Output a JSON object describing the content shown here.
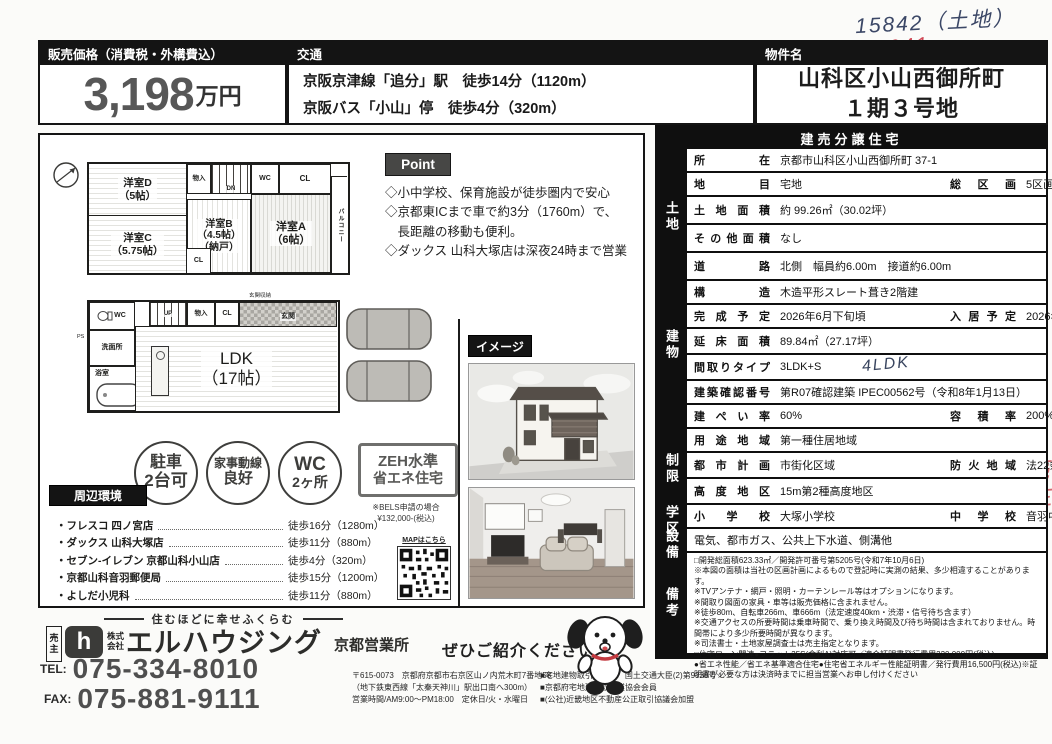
{
  "annotations": {
    "note_dark": "15842（土地）",
    "note_red": "16041",
    "side_note": "売主"
  },
  "header": {
    "price_label": "販売価格（消費税・外構費込）",
    "price_value": "3,198",
    "price_unit": "万円",
    "transport_label": "交通",
    "transport_line1": "京阪京津線「追分」駅　徒歩14分（1120m）",
    "transport_line2": "京阪バス「小山」停　徒歩4分（320m）",
    "property_label": "物件名",
    "property_line1": "山科区小山西御所町",
    "property_line2": "１期３号地"
  },
  "floorplan": {
    "f2": {
      "room_d": "洋室D\n（5帖）",
      "room_c": "洋室C\n（5.75帖）",
      "room_b": "洋室B\n（4.5帖）\n（納戸）",
      "room_a": "洋室A\n（6帖）",
      "closet": "物入",
      "wc": "WC",
      "cl_top": "CL",
      "cl_mid": "CL",
      "balcony": "バルコニー",
      "dn": "DN"
    },
    "f1": {
      "wc": "WC",
      "ps": "PS",
      "wash": "洗面所",
      "bath": "浴室",
      "ldk": "LDK\n（17帖）",
      "up": "UP",
      "closet": "物入",
      "cl": "CL",
      "entrance": "玄関",
      "entrance_storage": "玄関収納"
    }
  },
  "point": {
    "label": "Point",
    "item1": "◇小中学校、保育施設が徒歩圏内で安心",
    "item2": "◇京都東ICまで車で約3分（1760m）で、\n　長距離の移動も便利。",
    "item3": "◇ダックス 山科大塚店は深夜24時まで営業"
  },
  "badges": {
    "b1_top": "駐車",
    "b1_bottom": "2台可",
    "b2_top": "家事動線",
    "b2_bottom": "良好",
    "b3_top": "WC",
    "b3_bottom": "2ヶ所",
    "zeh_line1": "ZEH水準",
    "zeh_line2": "省エネ住宅",
    "zeh_note1": "※BELS申請の場合",
    "zeh_note2": "¥132,000-(税込)"
  },
  "surroundings": {
    "label": "周辺環境",
    "map_label": "MAPはこちら",
    "items": [
      {
        "name": "・フレスコ 四ノ宮店",
        "walk": "徒歩16分（1280m）"
      },
      {
        "name": "・ダックス 山科大塚店",
        "walk": "徒歩11分（880m）"
      },
      {
        "name": "・セブン-イレブン 京都山科小山店",
        "walk": "徒歩4分（320m）"
      },
      {
        "name": "・京都山科音羽郵便局",
        "walk": "徒歩15分（1200m）"
      },
      {
        "name": "・よしだ小児科",
        "walk": "徒歩11分（880m）"
      }
    ]
  },
  "image_section": {
    "label": "イメージ"
  },
  "spec_table": {
    "title": "建売分譲住宅",
    "groups": {
      "land": "土地",
      "building": "建物",
      "restriction": "制限",
      "school": "学区",
      "equipment": "設備",
      "remarks": "備考"
    },
    "rows": [
      {
        "label": "所在",
        "value": "京都市山科区小山西御所町 37-1"
      },
      {
        "label": "地目",
        "value": "宅地",
        "label2": "総区画",
        "value2": "5区画"
      },
      {
        "label": "土地面積",
        "value": "約 99.26㎡（30.02坪）"
      },
      {
        "label": "その他面積",
        "value": "なし"
      },
      {
        "label": "道路",
        "value": "北側　幅員約6.00m　接道約6.00m"
      },
      {
        "label": "構造",
        "value": "木造平形スレート葺き2階建"
      },
      {
        "label": "完成予定",
        "value": "2026年6月下旬頃",
        "label2": "入居予定",
        "value2": "2026年7月上旬頃"
      },
      {
        "label": "延床面積",
        "value": "89.84㎡（27.17坪）"
      },
      {
        "label": "間取りタイプ",
        "value": "3LDK+S",
        "handwritten": "4LDK"
      },
      {
        "label": "建築確認番号",
        "value": "第R07確認建築 IPEC00562号（令和8年1月13日）"
      },
      {
        "label": "建ぺい率",
        "value": "60%",
        "label2": "容積率",
        "value2": "200%"
      },
      {
        "label": "用途地域",
        "value": "第一種住居地域"
      },
      {
        "label": "都市計画",
        "value": "市街化区域",
        "label2": "防火地域",
        "value2": "法22条区域"
      },
      {
        "label": "高度地区",
        "value": "15m第2種高度地区"
      },
      {
        "label": "小学校",
        "value": "大塚小学校",
        "label2": "中学校",
        "value2": "音羽中学校"
      },
      {
        "value": "電気、都市ガス、公共上下水道、側溝他"
      },
      {
        "value": "□開発総面積623.33㎡／開発許可番号第5205号(令和7年10月6日)\n※本図の面積は当社の区画計画によるもので登記時に実測の結果、多少相違することがあります。\n※TVアンテナ・網戸・照明・カーテンレール等はオプションになります。\n※間取り図面の家具・車等は販売価格に含まれません。\n※徒歩80m、自転車266m、車666m（法定速度40km・渋滞・信号待ち含ます）\n※交通アクセスの所要時間は乗車時間で、乗り換え時間及び待ち時間は含まれておりません。時間帯により多少所要時間が異なります。\n※司法書士・土地家屋調査士は売主指定となります。\n□住宅ローン関連●フラット35S(金利A)対応可／適合証明書発行費用220,000円(税込)\n●省エネ性能／省エネ基準適合住宅●住宅省エネルギー性能証明書／発行費用16,500円(税込)※証明書が必要な方は決済時までに担当営業へお申し付けください"
      }
    ]
  },
  "footer": {
    "tagline": "住むほどに幸せふくらむ",
    "seller_badge": "売主",
    "logo_mark": "h",
    "company_prefix": "株式\n会社",
    "company_name": "エルハウジング",
    "branch": "京都営業所",
    "tel_label": "TEL:",
    "tel": "075-334-8010",
    "fax_label": "FAX:",
    "fax": "075-881-9111",
    "referral": "ぜひご紹介ください！",
    "address1": "〒615-0073　京都府京都市右京区山ノ内荒木町7番地58",
    "address2": "（地下鉄東西線「太秦天神川」駅出口南へ300m）",
    "address3": "営業時間/AM9:00〜PM18:00　定休日/火・水曜日",
    "license1": "■宅地建物取引業許可　国土交通大臣(2)第9338号",
    "license2": "■京都府宅地建物取引業協会会員",
    "license3": "■(公社)近畿地区不動産公正取引協議会加盟"
  }
}
